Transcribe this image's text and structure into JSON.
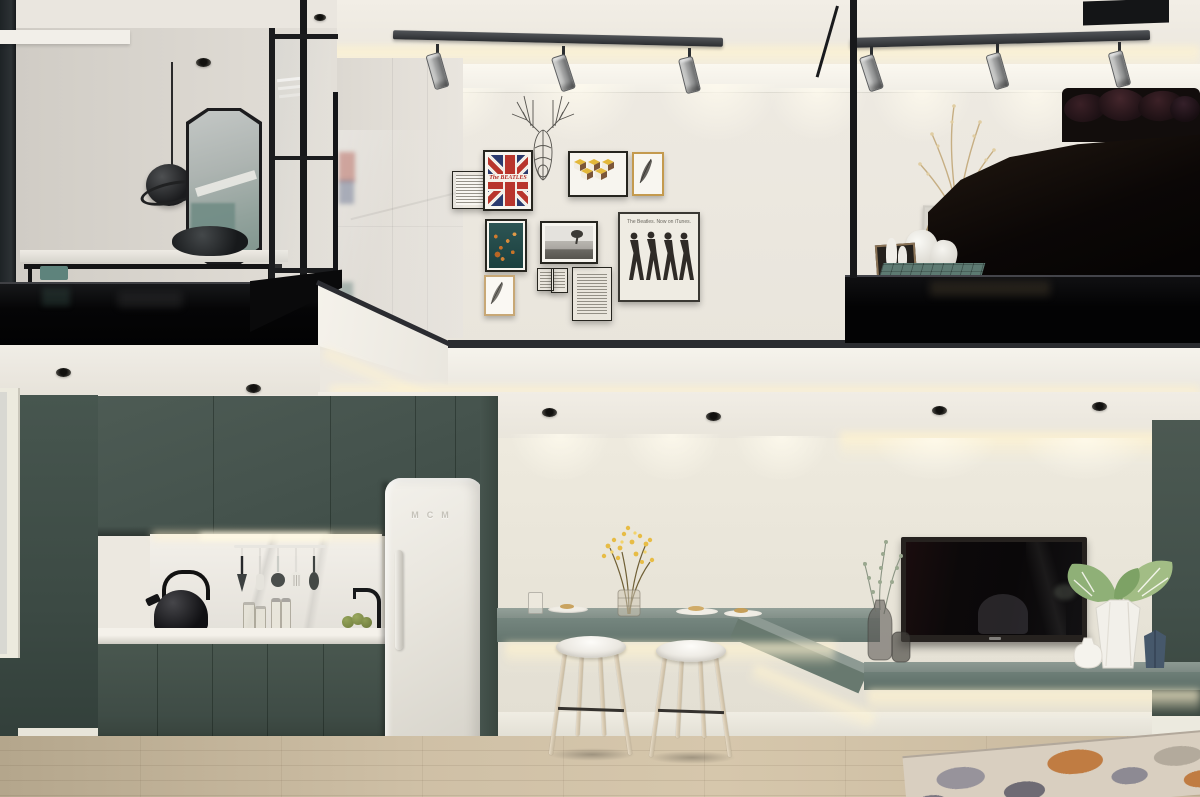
{
  "meta": {
    "subject": "Loft studio apartment interior - 3D visualization",
    "view": "Two levels: mezzanine bedroom and dressing area above; kitchen, breakfast bar and TV wall below"
  },
  "texts": {
    "itunes_caption": "The Beatles. Now on iTunes.",
    "union_jack_title": "The BEATLES",
    "fridge_logo": "MCM"
  },
  "palette": {
    "upper_wall": "#ece8e0",
    "left_room_wall": "#d6d2cb",
    "mezzanine_black": "#070708",
    "fascia_white": "#f2efe9",
    "lower_wall": "#eae6db",
    "cabinet_green": "#46544e",
    "bar_green": "#6e7f79",
    "shelf_top": "#87948d",
    "countertop": "#efece5",
    "marble_backsplash": "#e9e6e0",
    "fridge": "#e9e6df",
    "floor_wood": "#ccbca2",
    "led_glow": "#ffefc9",
    "rug_base": "#d9cfc0",
    "rug_orange": "#c07c42",
    "rug_gray": "#8f8d96",
    "teal_accent": "#5e837c"
  },
  "upper_level": {
    "dressing_area": {
      "objects": [
        "sliding-glass-door",
        "pendant-lamp",
        "octagon-mirror",
        "vanity-counter",
        "black-basin",
        "glass-partition",
        "recessed-spotlight"
      ]
    },
    "gallery_wall": {
      "sculpture": "wire-deer-head",
      "frames": [
        "typography-print-small",
        "union-jack-beatles-print",
        "geometric-cubes-print",
        "feather-print-gold-frame",
        "teal-floral-abstract",
        "black-white-landscape-photo",
        "mini-frame-pair",
        "typography-print-large",
        "feather-sketch-wood-frame",
        "beatles-itunes-poster"
      ]
    },
    "bedroom": {
      "objects": [
        "black-metal-railing",
        "dark-bed",
        "khaki-throw",
        "dark-pillows",
        "dry-branches-arrangement",
        "leaning-art-frames",
        "white-bottle-vases",
        "teal-grid-side-table"
      ]
    },
    "lighting": {
      "track_rails": 2,
      "spotlights_per_rail": 3,
      "cove_led": true
    }
  },
  "lower_level": {
    "kitchen": {
      "objects": [
        "upper-cabinets",
        "marble-backsplash",
        "under-cabinet-led",
        "utensil-rail",
        "black-kettle",
        "black-tray",
        "glass-canisters",
        "spice-shakers",
        "black-faucet",
        "sink",
        "green-fruit",
        "base-cabinets",
        "retro-fridge"
      ]
    },
    "breakfast_bar": {
      "objects": [
        "floating-bar-counter",
        "under-counter-led",
        "yellow-flower-vase",
        "drinking-glass",
        "breakfast-plates"
      ],
      "stool_count": 2
    },
    "tv_wall": {
      "objects": [
        "wall-mounted-tv",
        "eucalyptus-glass-vases",
        "monstera-white-vase",
        "small-white-vase",
        "blue-facet-vase",
        "floating-media-shelf",
        "green-side-panel"
      ]
    },
    "floor": {
      "objects": [
        "oak-plank-floor",
        "abstract-area-rug",
        "white-baseboard"
      ]
    }
  }
}
